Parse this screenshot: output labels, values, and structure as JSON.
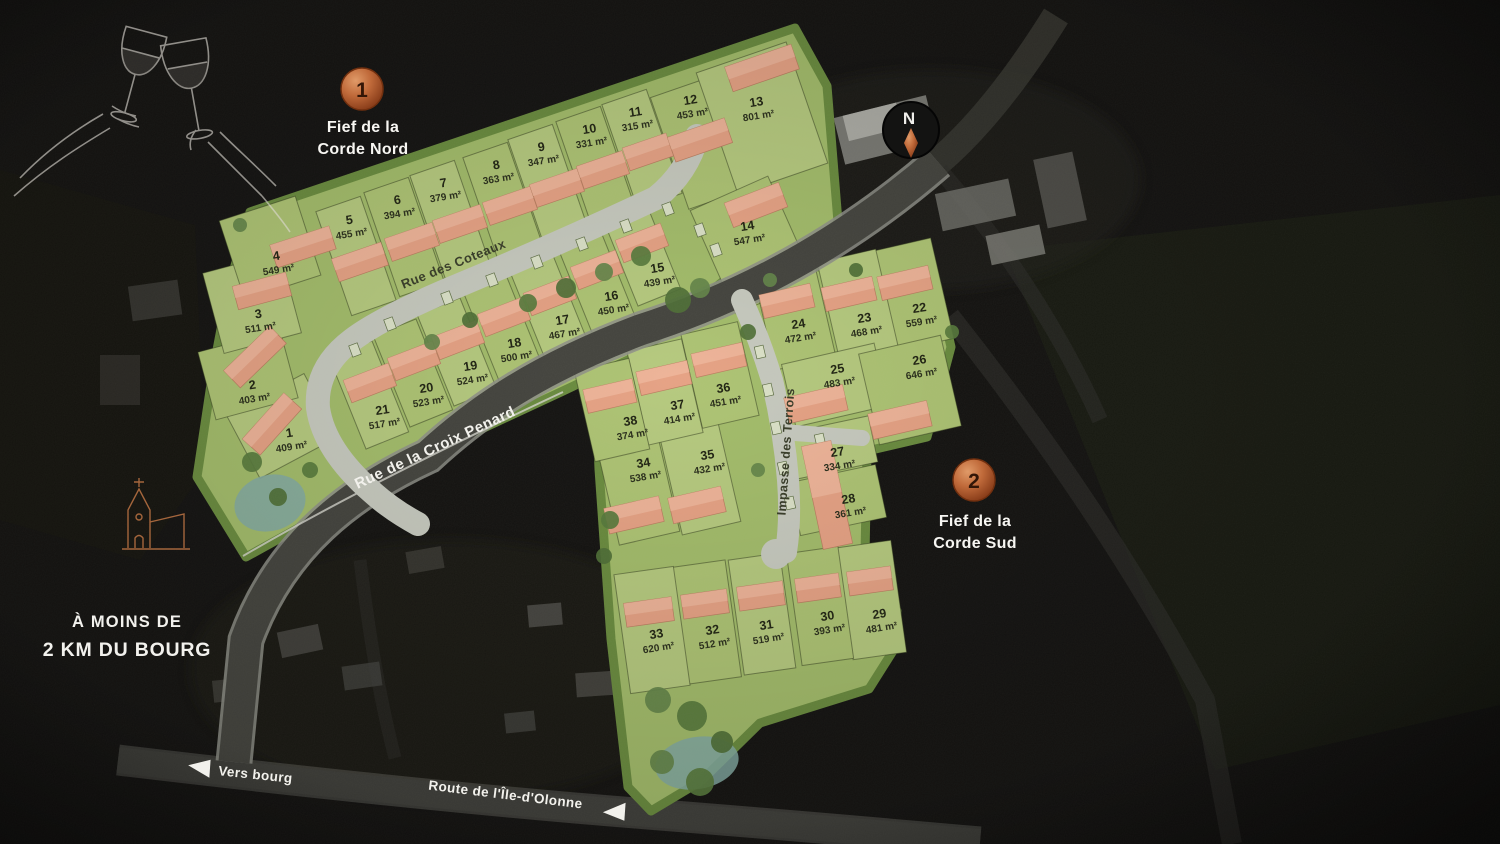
{
  "badges": [
    {
      "number": "1",
      "lines": [
        "Fief de la",
        "Corde Nord"
      ]
    },
    {
      "number": "2",
      "lines": [
        "Fief de la",
        "Corde Sud"
      ]
    }
  ],
  "streets": [
    {
      "name": "Rue des Coteaux"
    },
    {
      "name": "Rue de la Croix Penard"
    },
    {
      "name": "Impasse des Terrois"
    },
    {
      "name": "Route de l'Île-d'Olonne"
    }
  ],
  "signs": {
    "vers_bourg": "Vers bourg",
    "distance_lines": [
      "À MOINS DE",
      "2 KM DU BOURG"
    ],
    "compass_n": "N"
  },
  "lots": [
    {
      "num": "1",
      "area": "409 m²",
      "x": 290,
      "y": 437
    },
    {
      "num": "2",
      "area": "403 m²",
      "x": 253,
      "y": 389
    },
    {
      "num": "3",
      "area": "511 m²",
      "x": 259,
      "y": 318
    },
    {
      "num": "4",
      "area": "549 m²",
      "x": 277,
      "y": 260
    },
    {
      "num": "5",
      "area": "455 m²",
      "x": 350,
      "y": 224
    },
    {
      "num": "6",
      "area": "394 m²",
      "x": 398,
      "y": 204
    },
    {
      "num": "7",
      "area": "379 m²",
      "x": 444,
      "y": 187
    },
    {
      "num": "8",
      "area": "363 m²",
      "x": 497,
      "y": 169
    },
    {
      "num": "9",
      "area": "347 m²",
      "x": 542,
      "y": 151
    },
    {
      "num": "10",
      "area": "331 m²",
      "x": 590,
      "y": 133
    },
    {
      "num": "11",
      "area": "315 m²",
      "x": 636,
      "y": 116
    },
    {
      "num": "12",
      "area": "453 m²",
      "x": 691,
      "y": 104
    },
    {
      "num": "13",
      "area": "801 m²",
      "x": 757,
      "y": 106
    },
    {
      "num": "14",
      "area": "547 m²",
      "x": 748,
      "y": 230
    },
    {
      "num": "15",
      "area": "439 m²",
      "x": 658,
      "y": 272
    },
    {
      "num": "16",
      "area": "450 m²",
      "x": 612,
      "y": 300
    },
    {
      "num": "17",
      "area": "467 m²",
      "x": 563,
      "y": 324
    },
    {
      "num": "18",
      "area": "500 m²",
      "x": 515,
      "y": 347
    },
    {
      "num": "19",
      "area": "524 m²",
      "x": 471,
      "y": 370
    },
    {
      "num": "20",
      "area": "523 m²",
      "x": 427,
      "y": 392
    },
    {
      "num": "21",
      "area": "517 m²",
      "x": 383,
      "y": 414
    },
    {
      "num": "22",
      "area": "559 m²",
      "x": 920,
      "y": 312
    },
    {
      "num": "23",
      "area": "468 m²",
      "x": 865,
      "y": 322
    },
    {
      "num": "24",
      "area": "472 m²",
      "x": 799,
      "y": 328
    },
    {
      "num": "25",
      "area": "483 m²",
      "x": 838,
      "y": 373
    },
    {
      "num": "26",
      "area": "646 m²",
      "x": 920,
      "y": 364
    },
    {
      "num": "27",
      "area": "334 m²",
      "x": 838,
      "y": 456
    },
    {
      "num": "28",
      "area": "361 m²",
      "x": 849,
      "y": 503
    },
    {
      "num": "29",
      "area": "481 m²",
      "x": 880,
      "y": 618
    },
    {
      "num": "30",
      "area": "393 m²",
      "x": 828,
      "y": 620
    },
    {
      "num": "31",
      "area": "519 m²",
      "x": 767,
      "y": 629
    },
    {
      "num": "32",
      "area": "512 m²",
      "x": 713,
      "y": 634
    },
    {
      "num": "33",
      "area": "620 m²",
      "x": 657,
      "y": 638
    },
    {
      "num": "34",
      "area": "538 m²",
      "x": 644,
      "y": 467
    },
    {
      "num": "35",
      "area": "432 m²",
      "x": 708,
      "y": 459
    },
    {
      "num": "36",
      "area": "451 m²",
      "x": 724,
      "y": 392
    },
    {
      "num": "37",
      "area": "414 m²",
      "x": 678,
      "y": 409
    },
    {
      "num": "38",
      "area": "374 m²",
      "x": 631,
      "y": 425
    }
  ],
  "colors": {
    "accent_copper": "#b05429",
    "lot_green": "#b6ca7e",
    "estate_green": "#a3bd6a",
    "house_salmon": "#e7a284",
    "road_light": "#c7cabf",
    "road_dark": "#403f3a"
  }
}
